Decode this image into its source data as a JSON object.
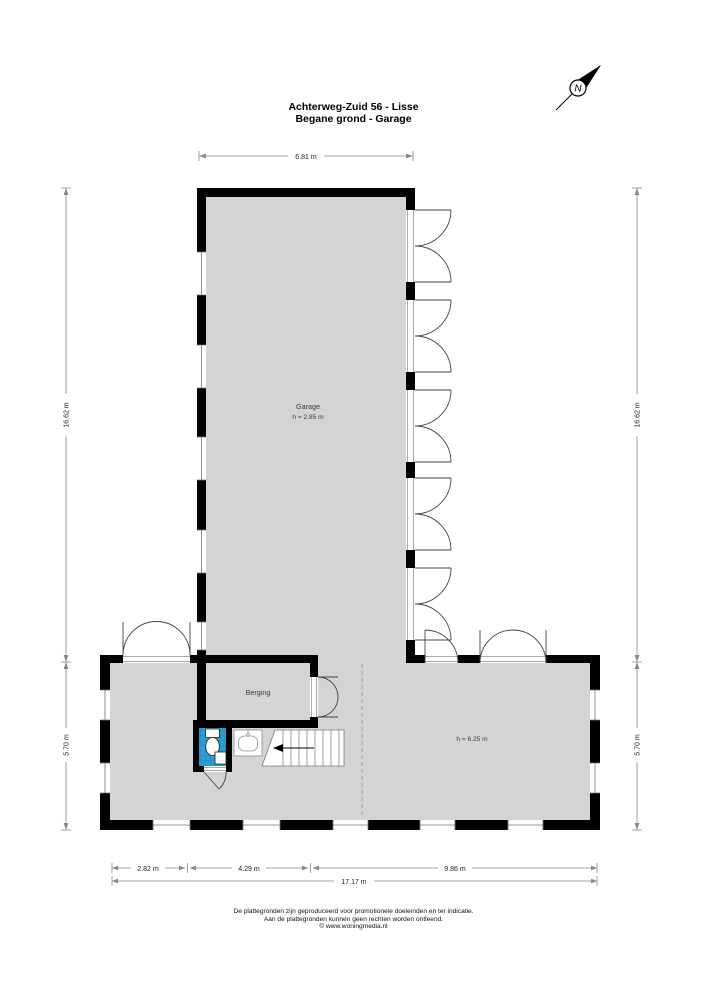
{
  "title": {
    "line1": "Achterweg-Zuid 56 - Lisse",
    "line2": "Begane grond - Garage"
  },
  "compass": {
    "north_label": "N"
  },
  "rooms": {
    "garage": {
      "name": "Garage",
      "ceiling_height": "h = 2.85 m"
    },
    "berging": {
      "name": "Berging"
    },
    "open_space": {
      "ceiling_height": "h = 6.25 m"
    }
  },
  "dimensions": {
    "garage_width": "6.81 m",
    "left_height_upper": "16.62 m",
    "left_height_lower": "5.70 m",
    "right_height_upper": "16.62 m",
    "right_height_lower": "5.70 m",
    "bottom_segment_1": "2.82 m",
    "bottom_segment_2": "4.29 m",
    "bottom_segment_3": "9.86 m",
    "bottom_total": "17.17 m"
  },
  "footer": {
    "line1": "De plattegronden zijn geproduceerd voor promotionele doeleinden en ter indicatie.",
    "line2": "Aan de plattegronden kunnen geen rechten worden ontleend.",
    "line3": "© www.woningmedia.nl"
  },
  "colors": {
    "floor": "#d4d4d4",
    "wall": "#000000",
    "tile": "#2aa0d2",
    "tile_grid": "#1b7fae",
    "door_line": "#444444",
    "dimension_line": "#888888"
  }
}
